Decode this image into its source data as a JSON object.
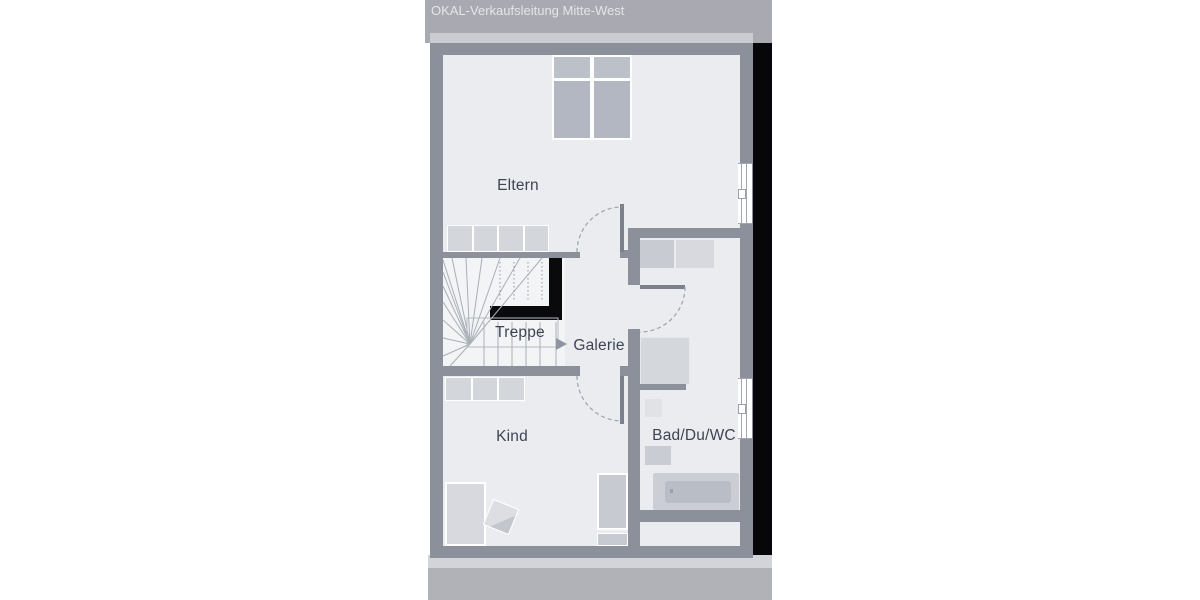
{
  "watermark": "OKAL-Verkaufsleitung Mitte-West",
  "rooms": {
    "eltern": "Eltern",
    "treppe": "Treppe",
    "galerie": "Galerie",
    "kind": "Kind",
    "bad": "Bad/Du/WC"
  },
  "icons": {
    "stair_direction_arrow": "right-arrow"
  },
  "colors": {
    "wall": "#8b909b",
    "floor": "#eaecf0",
    "stairwell_floor": "#f3f4f6",
    "party_wall_black": "#070709",
    "stair_railing_black": "#0a0a0c",
    "furniture_light": "#d3d6db",
    "furniture_medium": "#c7cad1",
    "bed_fill": "#b3b7c1",
    "pillow_fill": "#bcc0c9",
    "top_band": "#a9aab1",
    "bottom_band": "#b1b2b8",
    "light_strip": "#cbccd2",
    "label_text": "#3e4452",
    "watermark_text": "#eeeff2",
    "door_arc": "#a2a8b2",
    "stair_lines": "#a9aeb7"
  }
}
